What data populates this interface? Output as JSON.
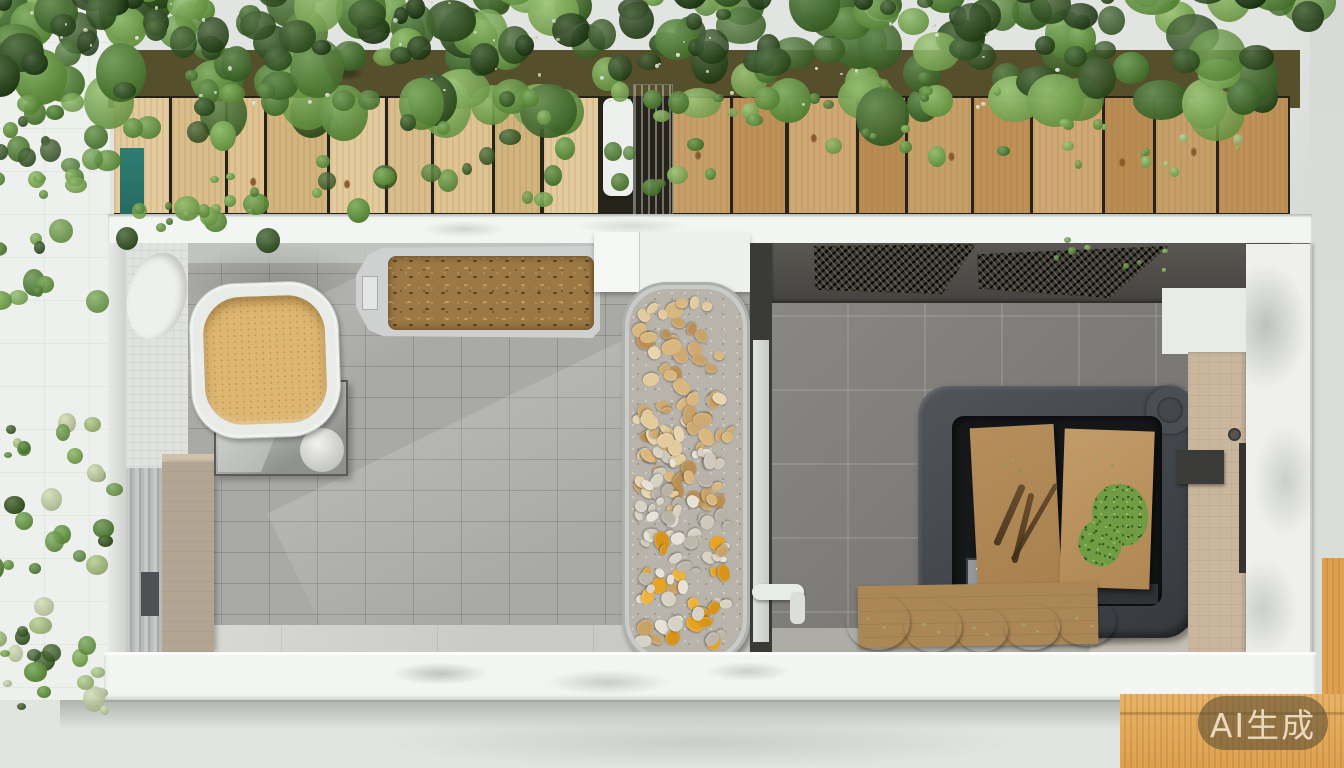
{
  "watermark": {
    "text": "AI生成"
  },
  "scene": {
    "description": "Top-down cutaway view of an AI-generated tiled pet/utility room: green roof planting over a row of wooden planks, left room with a tan honeycomb basin on a metal mat and a tray of brown pellets, a long central tray of tan/white/orange pebbles, right room with dark mesh vents, a charcoal storage bin holding two cardboard boxes with plant tufts, garlic bulbs on cardboard, beige door and marble column on the right, white ledges top and bottom, orange corrugated panel at bottom right",
    "regions": {
      "green-roof": "dense foliage with tiny pale flowers",
      "plank-row": "vertical light wood planks over dark soil",
      "left-room": "light gray tiled room",
      "basin": "white rounded basin with tan honeycomb liquid",
      "pellet-tray": "gray tray filled with brown pellets",
      "pebble-tray": "long tray: tan pebbles, white stones, orange chips",
      "right-room": "dark gray tiled room with two mesh vents",
      "storage-bin": "charcoal bin with two cardboard boxes and plants",
      "garlic-row": "white garlic bulbs on cardboard",
      "right-wall": "beige door, latch, white marble column",
      "orange-panel": "orange corrugated cardboard at bottom right"
    }
  },
  "palette": {
    "extBottom": "#e2e4e1",
    "ledge": "#f3f5f2",
    "leftRoom": "#a9a9a6",
    "rightRoomA": "#8b8985",
    "rightRoomB": "#6d6b67",
    "bin": "#35383c",
    "basinTan": "#ddb671",
    "pellet": "#9c7844",
    "beigeCab": "#b2a693",
    "beigeDoor": "#c9b69d",
    "marble": "#eff0ee",
    "orange": "#dfa14e",
    "cardboard": "#ab8756",
    "teal": "#2f7d72",
    "wmBg": "rgba(88,76,50,0.58)",
    "wmFg": "#ead9bd"
  },
  "decor": {
    "planks": {
      "top": 2,
      "height": 115,
      "gap": 3,
      "groups": [
        {
          "x": 0,
          "span": 484,
          "tones": [
            "#e3cb9e",
            "#d9bd8a",
            "#e0c392",
            "#d2b47e"
          ],
          "widths": [
            57,
            56,
            38,
            62,
            58,
            45,
            60,
            48,
            57
          ]
        },
        {
          "x": 558,
          "span": 616,
          "tones": [
            "#c79f68",
            "#bd9157",
            "#cfa873",
            "#b98c52"
          ],
          "widths": [
            60,
            55,
            70,
            48,
            66,
            58,
            72,
            50,
            62,
            72
          ]
        }
      ]
    },
    "pebbles": {
      "zones": [
        {
          "seed": 11,
          "x": 3,
          "y": 8,
          "w": 104,
          "h": 218,
          "n": 85,
          "min": 9,
          "max": 20,
          "palette": [
            "#d9b77e",
            "#c9a268",
            "#e3cb9c",
            "#b98f55",
            "#cfa972",
            "#e8d4ae"
          ]
        },
        {
          "seed": 22,
          "x": 3,
          "y": 158,
          "w": 104,
          "h": 112,
          "n": 42,
          "min": 8,
          "max": 16,
          "palette": [
            "#e7e2d6",
            "#cfc9bb",
            "#d8d2c4",
            "#b9b3a5",
            "#d9b77e"
          ]
        },
        {
          "seed": 33,
          "x": 3,
          "y": 238,
          "w": 104,
          "h": 122,
          "n": 50,
          "min": 8,
          "max": 18,
          "palette": [
            "#e8a322",
            "#f0b33a",
            "#d89418",
            "#d8d2c4",
            "#bdb7a9",
            "#e7e2d6",
            "#c9a268"
          ]
        }
      ]
    },
    "garlic": [
      {
        "x": 846,
        "y": 594,
        "w": 64,
        "h": 56
      },
      {
        "x": 904,
        "y": 602,
        "w": 58,
        "h": 50
      },
      {
        "x": 956,
        "y": 608,
        "w": 52,
        "h": 44
      },
      {
        "x": 1004,
        "y": 604,
        "w": 56,
        "h": 46
      },
      {
        "x": 1056,
        "y": 596,
        "w": 60,
        "h": 50
      }
    ],
    "foliage_zones": [
      {
        "seed": 1,
        "n": 160,
        "x": -30,
        "w": 1340,
        "y": -40,
        "h": 130,
        "rmin": 20,
        "rmax": 58,
        "palette": [
          "#3f6d27",
          "#4f8230",
          "#639a3c",
          "#77ad4a",
          "#2c4f1a",
          "#86b958"
        ]
      },
      {
        "seed": 2,
        "n": 70,
        "x": -20,
        "w": 1320,
        "y": -30,
        "h": 85,
        "rmin": 14,
        "rmax": 40,
        "palette": [
          "#244315",
          "#2e531c",
          "#1d3a10"
        ]
      },
      {
        "seed": 3,
        "n": 26,
        "x": -10,
        "w": 270,
        "y": 70,
        "h": 160,
        "rmin": 10,
        "rmax": 28,
        "palette": [
          "#4f8230",
          "#639a3c",
          "#77ad4a",
          "#2c4f1a"
        ]
      },
      {
        "seed": 4,
        "n": 22,
        "x": 300,
        "w": 260,
        "y": 80,
        "h": 120,
        "rmin": 9,
        "rmax": 24,
        "palette": [
          "#4f8230",
          "#639a3c",
          "#77ad4a",
          "#355c20"
        ]
      },
      {
        "seed": 5,
        "n": 16,
        "x": 560,
        "w": 200,
        "y": 80,
        "h": 100,
        "rmin": 8,
        "rmax": 22,
        "palette": [
          "#4f8230",
          "#639a3c",
          "#86b958"
        ]
      },
      {
        "seed": 6,
        "n": 14,
        "x": 760,
        "w": 240,
        "y": 70,
        "h": 80,
        "rmin": 8,
        "rmax": 20,
        "palette": [
          "#4f8230",
          "#639a3c",
          "#77ad4a"
        ]
      },
      {
        "seed": 7,
        "n": 14,
        "x": 1020,
        "w": 220,
        "y": 90,
        "h": 80,
        "rmin": 5,
        "rmax": 13,
        "palette": [
          "#639a3c",
          "#86b958",
          "#a9c77f"
        ]
      },
      {
        "seed": 8,
        "n": 28,
        "x": -15,
        "w": 150,
        "y": 80,
        "h": 220,
        "rmin": 9,
        "rmax": 26,
        "palette": [
          "#4f8230",
          "#639a3c",
          "#77ad4a",
          "#2c4f1a"
        ]
      },
      {
        "seed": 9,
        "n": 10,
        "x": 150,
        "w": 115,
        "y": 148,
        "h": 85,
        "rmin": 5,
        "rmax": 13,
        "palette": [
          "#639a3c",
          "#77ad4a",
          "#4f8230"
        ]
      },
      {
        "seed": 10,
        "n": 50,
        "x": -25,
        "w": 140,
        "y": 408,
        "h": 300,
        "rmin": 8,
        "rmax": 24,
        "palette": [
          "#4f8230",
          "#639a3c",
          "#77ad4a",
          "#a9c77f",
          "#c9d8a8",
          "#35591f"
        ]
      },
      {
        "seed": 12,
        "n": 55,
        "x": -10,
        "w": 1100,
        "y": -5,
        "h": 110,
        "rmin": 2,
        "rmax": 5,
        "palette": [
          "#e3ead0",
          "#eef2da",
          "#d8e2b8"
        ]
      },
      {
        "seed": 13,
        "n": 8,
        "x": 1050,
        "w": 200,
        "y": 235,
        "h": 38,
        "rmin": 4,
        "rmax": 10,
        "palette": [
          "#639a3c",
          "#86b958"
        ]
      }
    ]
  }
}
